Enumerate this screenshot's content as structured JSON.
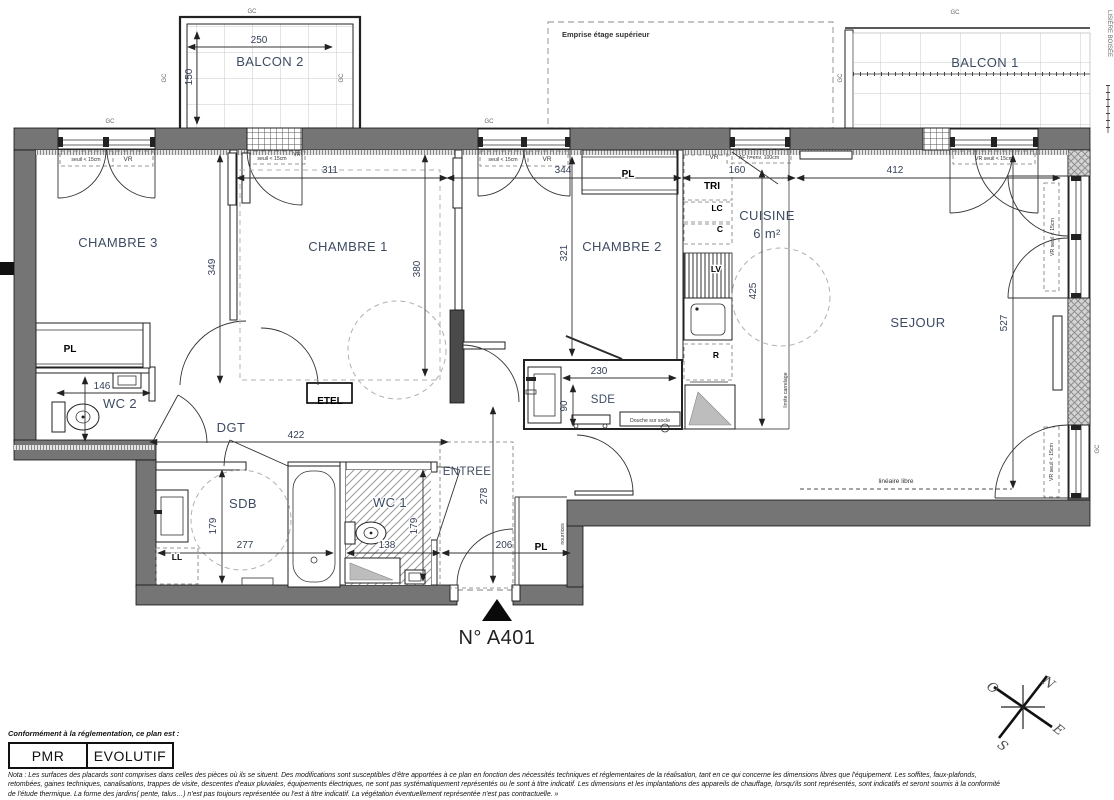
{
  "plan_number": "N° A401",
  "rooms": {
    "balcon1": "BALCON 1",
    "balcon2": "BALCON 2",
    "chambre1": "CHAMBRE 1",
    "chambre2": "CHAMBRE 2",
    "chambre3": "CHAMBRE 3",
    "cuisine": "CUISINE",
    "cuisine_area": "6 m²",
    "sejour": "SEJOUR",
    "sde": "SDE",
    "sdb": "SDB",
    "wc1": "WC 1",
    "wc2": "WC 2",
    "dgt": "DGT",
    "entree": "ENTREE"
  },
  "equipment": {
    "pl": "PL",
    "etel": "ETEL",
    "tri": "TRI",
    "lc": "LC",
    "c": "C",
    "lv": "LV",
    "r": "R",
    "ll": "LL"
  },
  "dims": {
    "d250": "250",
    "d150": "150",
    "d311": "311",
    "d344": "344",
    "d160": "160",
    "d412": "412",
    "d349": "349",
    "d380": "380",
    "d321": "321",
    "d425": "425",
    "d527": "527",
    "d146": "146",
    "d422": "422",
    "d230": "230",
    "d90": "90",
    "d277": "277",
    "d138": "138",
    "d179": "179",
    "d278": "278",
    "d206": "206"
  },
  "annotations": {
    "emprise": "Emprise étage supérieur",
    "lisiere": "LISIÈRE BOISÉE",
    "gc": "GC",
    "vr": "VR",
    "seuil": "seuil < 15cm",
    "vr_seuil": "VR seuil < 15cm",
    "af": "AF h=env. 100cm",
    "douche": "Douche sur socle",
    "limite": "limite carrelage",
    "lineaire": "linéaire libre",
    "nourrices": "nourrices"
  },
  "compass": {
    "n": "N",
    "e": "E",
    "s": "S",
    "o": "O"
  },
  "footer": {
    "conformity_label": "Conformément à la réglementation, ce plan est :",
    "pmr": "PMR",
    "evolutif": "EVOLUTIF",
    "nota_lines": [
      "Nota : Les surfaces des placards sont comprises dans celles des pièces où ils se situent. Des modifications sont susceptibles d'être apportées à ce plan en fonction des nécessités techniques et réglementaires de la réalisation, tant en ce qui concerne les dimensions libres que l'équipement.  Les soffites, faux-plafonds,",
      "retombées, gaines techniques, canalisations, trappes de visite, descentes d'eaux pluviales, équipements électriques, ne sont pas systématiquement représentés ou le sont à titre indicatif. Les dimensions et les implantations des appareils de chauffage, lorsqu'ils sont représentés, sont indicatifs et seront soumis à la conformité",
      "de l'étude thermique. La forme des jardins( pente, talus…) n'est pas toujours représentée ou l'est à titre indicatif. La végétation éventuellement représentée n'est pas contractuelle. »"
    ]
  }
}
